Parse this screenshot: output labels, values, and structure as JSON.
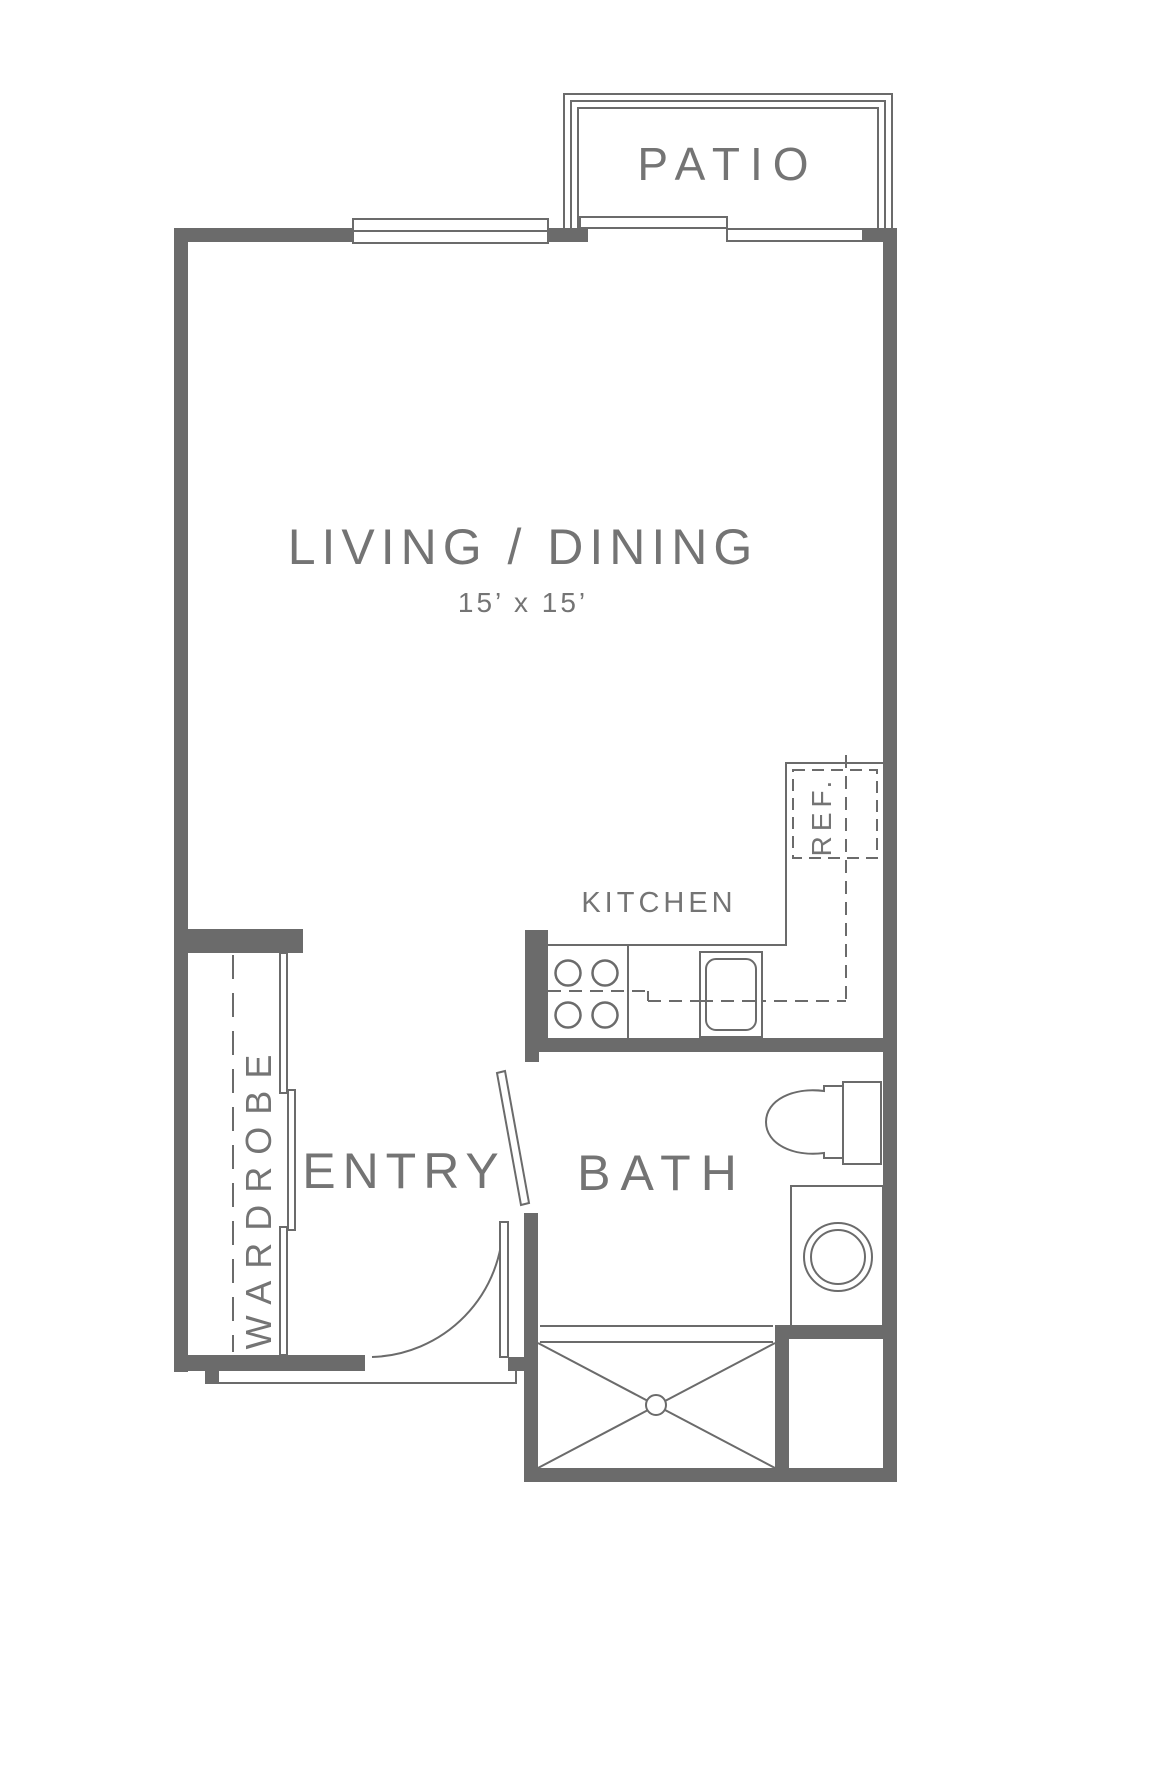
{
  "plan": {
    "labels": {
      "patio": "PATIO",
      "living_dining": "LIVING / DINING",
      "living_dims": "15’ x 15’",
      "kitchen": "KITCHEN",
      "ref": "REF.",
      "wardrobe": "WARDROBE",
      "entry": "ENTRY",
      "bath": "BATH"
    },
    "colors": {
      "wall_line": "#6b6b6b",
      "text": "#747474",
      "background": "#ffffff"
    }
  }
}
